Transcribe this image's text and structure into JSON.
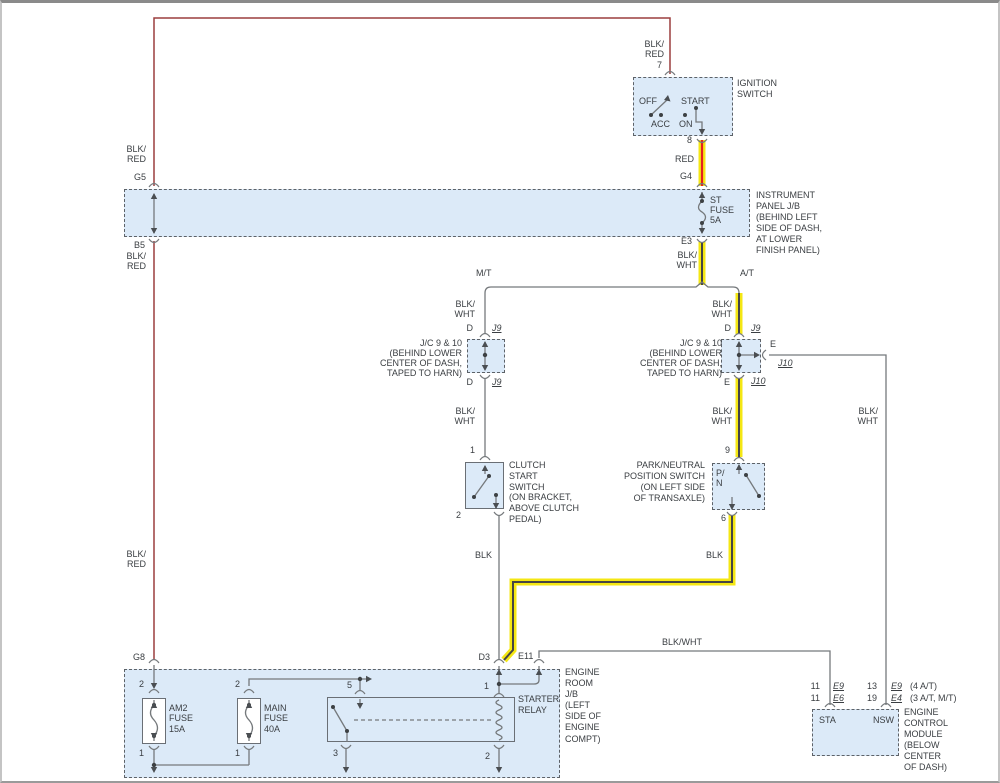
{
  "colors": {
    "highlight_yellow": "#f4e714",
    "wire_gray": "#75797c",
    "wire_core_dark": "#454545",
    "wire_blk_red": "#9c3f3f",
    "wire_bright_red": "#e51f1f",
    "box_fill": "#dceaf8",
    "text": "#3a3e42"
  },
  "ignition_switch": {
    "wire_top": "BLK/\nRED",
    "pin_top": "7",
    "title": "IGNITION\nSWITCH",
    "pos_off": "OFF",
    "pos_start": "START",
    "pos_acc": "ACC",
    "pos_on": "ON",
    "pin_bottom": "8",
    "wire_bottom": "RED"
  },
  "instrument_panel_jb": {
    "conn_g4": "G4",
    "title": "INSTRUMENT\nPANEL J/B\n(BEHIND LEFT\nSIDE OF DASH,\nAT LOWER\nFINISH PANEL)",
    "fuse_label": "ST\nFUSE\n5A",
    "conn_g5": "G5",
    "conn_b5": "B5",
    "conn_e3": "E3",
    "wire_left_top": "BLK/\nRED",
    "wire_left_bottom": "BLK/\nRED",
    "wire_e3": "BLK/\nWHT"
  },
  "branch": {
    "mt": "M/T",
    "at": "A/T"
  },
  "jc_mt": {
    "wire_top": "BLK/\nWHT",
    "conn_top_left": "D",
    "conn_top_right": "J9",
    "title": "J/C 9 & 10\n(BEHIND LOWER\nCENTER OF DASH,\nTAPED TO HARN)",
    "conn_bottom_left": "D",
    "conn_bottom_right": "J9",
    "wire_bottom": "BLK/\nWHT"
  },
  "jc_at": {
    "wire_top": "BLK/\nWHT",
    "conn_top_left": "D",
    "conn_top_right": "J9",
    "title": "J/C 9 & 10\n(BEHIND LOWER\nCENTER OF DASH,\nTAPED TO HARN)",
    "conn_right_top": "E",
    "conn_right_bottom": "J10",
    "conn_bottom_left": "E",
    "conn_bottom_right": "J10",
    "wire_bottom": "BLK/\nWHT"
  },
  "clutch_switch": {
    "pin_top": "1",
    "title": "CLUTCH\nSTART\nSWITCH\n(ON BRACKET,\nABOVE CLUTCH\nPEDAL)",
    "pin_bottom": "2",
    "wire_bottom": "BLK"
  },
  "pn_switch": {
    "pin_top": "9",
    "title": "PARK/NEUTRAL\nPOSITION SWITCH\n(ON LEFT SIDE\nOF TRANSAXLE)",
    "label": "P/\nN",
    "pin_bottom": "6",
    "wire_bottom": "BLK"
  },
  "right_branch": {
    "wire_right": "BLK/\nWHT"
  },
  "left_wire": {
    "label_mid": "BLK/\nRED",
    "conn_g8": "G8"
  },
  "bottom_wire": {
    "label": "BLK/WHT"
  },
  "engine_room_jb": {
    "conn_d3": "D3",
    "conn_e11": "E11",
    "title": "ENGINE\nROOM\nJ/B\n(LEFT\nSIDE OF\nENGINE\nCOMPT)",
    "am2": {
      "pin_top": "2",
      "label": "AM2\nFUSE\n15A",
      "pin_bottom": "1"
    },
    "main": {
      "pin_top": "2",
      "label": "MAIN\nFUSE\n40A",
      "pin_bottom": "1"
    },
    "relay": {
      "pin_5": "5",
      "pin_1": "1",
      "label": "STARTER\nRELAY",
      "pin_3": "3",
      "pin_2": "2"
    }
  },
  "ecm": {
    "rows": [
      {
        "pin_a": "11",
        "conn_a": "E9",
        "pin_b": "13",
        "conn_b": "E9",
        "note": "(4 A/T)"
      },
      {
        "pin_a": "11",
        "conn_a": "E6",
        "pin_b": "19",
        "conn_b": "E4",
        "note": "(3 A/T, M/T)"
      }
    ],
    "sta": "STA",
    "nsw": "NSW",
    "title": "ENGINE\nCONTROL\nMODULE\n(BELOW\nCENTER\nOF DASH)"
  }
}
